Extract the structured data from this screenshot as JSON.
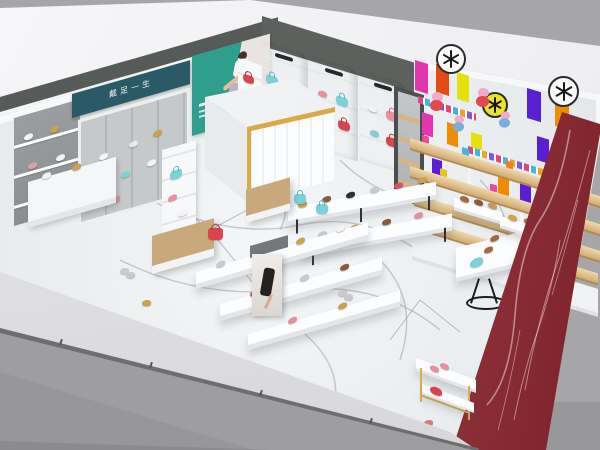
{
  "scene": {
    "description": "Aerial isometric 3D render of a shoe store interior: white marble floor, concrete and teal accent back wall, gold-trimmed marble cashier counter, white wall cabinets with shoes and handbags, colorful children's zone with cartoon pig stickers and snowflake badges, wood wall shelves, display tables with shoes, and a red marble side wall with the storefront glass band at lower left.",
    "view": "isometric aerial render"
  },
  "signage": {
    "brand_sign_text": "戴足一生",
    "brand_sign_bg": "#2b5a67",
    "poster_theme": "teal fashion poster with seated woman"
  },
  "decals": {
    "snowflake_badges": 3,
    "cartoon_pig_stickers": 4
  },
  "fixtures": [
    "concrete shelf wall",
    "brand sign",
    "mesh display wall",
    "wall shelf tower",
    "brand poster",
    "cashier counter",
    "white wall cabinets",
    "mirror panel",
    "kids stripe wall",
    "wood wall shelves",
    "long display tables",
    "tiered display tables",
    "bench seats",
    "fashion poster pillar",
    "wire-base table",
    "gold-frame stand",
    "floor risers",
    "red marble wall",
    "marble floor",
    "storefront glass band"
  ],
  "merchandise": [
    "women's shoes",
    "kids' shoes",
    "handbags"
  ],
  "colors": {
    "background_gray": "#a6a6a9",
    "outside_floor_gray": "#9e9ea1",
    "wall_top_white": "#f3f3f5",
    "concrete_gray": "#94979a",
    "dark_band": "#565b58",
    "brand_teal": "#2b5a67",
    "poster_teal": "#2f9e8c",
    "marble_floor": "#edeff1",
    "marble_vein": "#9aa0ad",
    "red_marble": "#8c2b33",
    "wood_shelf": "#d2ab72",
    "gold_trim": "#d8ab44",
    "kids_magenta": "#e335ae",
    "kids_red_orange": "#e34b12",
    "kids_yellow": "#e6e10e",
    "kids_purple": "#5a1fd2",
    "kids_orange": "#ef8d00",
    "peppa_pink": "#f2aac9",
    "bag_teal": "#7cd0d8",
    "bag_pink": "#e8919b",
    "bag_red": "#d9454f"
  }
}
